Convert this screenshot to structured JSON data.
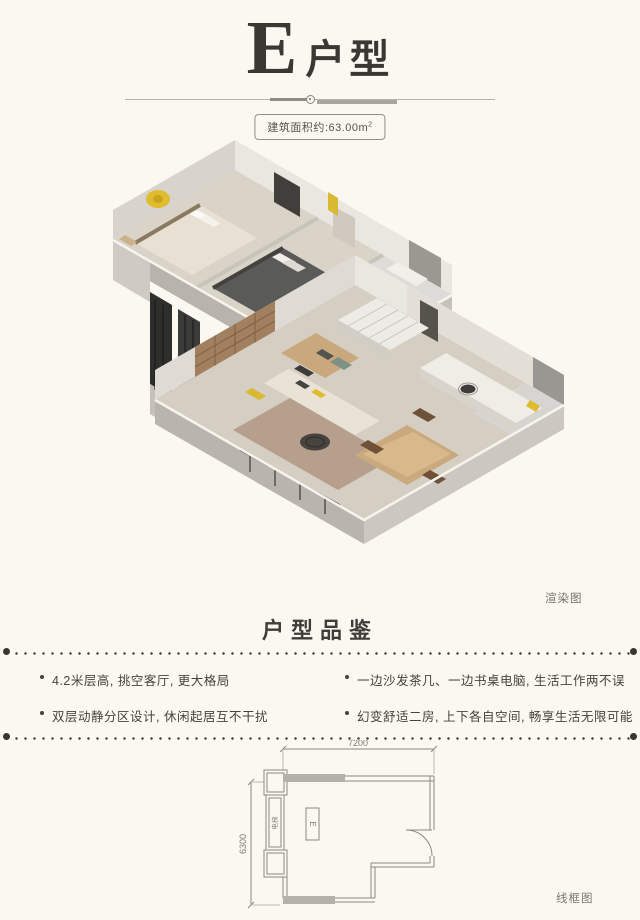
{
  "colors": {
    "background": "#faf8f0",
    "accent_yellow": "#d9b832",
    "ink": "#3a3833"
  },
  "header": {
    "title_letter": "E",
    "title_suffix": "户型",
    "area_badge": "建筑面积约:63.00m",
    "area_sup": "2"
  },
  "render": {
    "caption": "渲染图"
  },
  "features": {
    "title": "户型品鉴",
    "items_left": [
      "4.2米层高, 挑空客厅, 更大格局",
      "双层动静分区设计, 休闲起居互不干扰"
    ],
    "items_right": [
      "一边沙发茶几、一边书桌电脑, 生活工作两不误",
      "幻变舒适二房, 上下各自空间, 畅享生活无限可能"
    ]
  },
  "wireframe": {
    "caption": "线框图",
    "dim_width": "7200",
    "dim_height": "6300",
    "unit_marker": "E",
    "shaft_label": "电梯"
  }
}
